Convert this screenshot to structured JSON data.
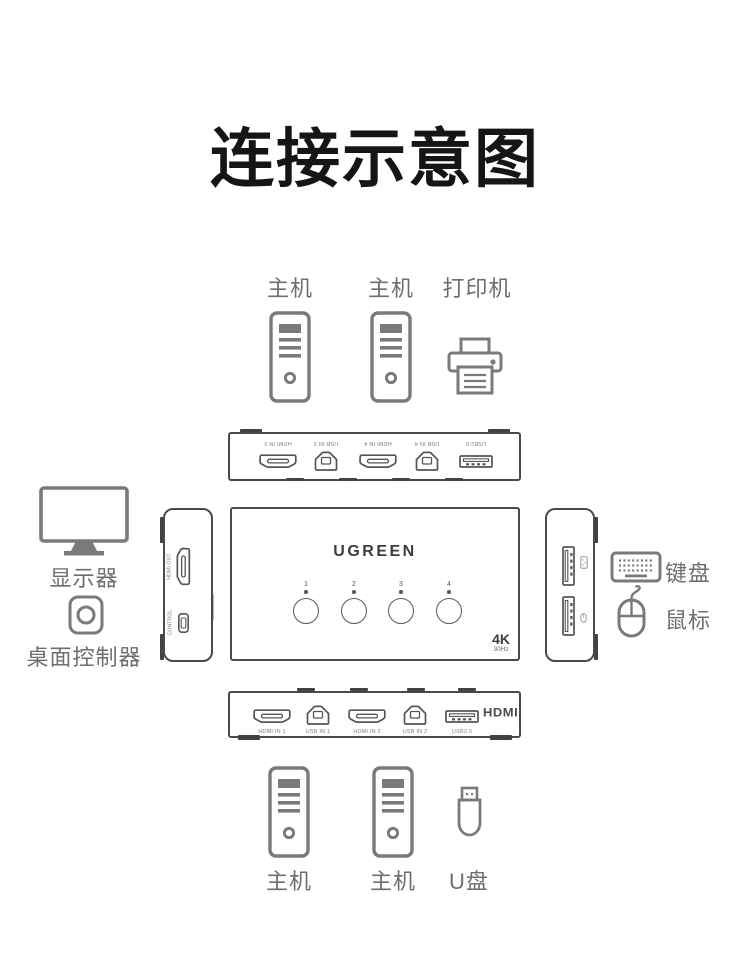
{
  "title": "连接示意图",
  "colors": {
    "title": "#151515",
    "line_art": "#7a7a7a",
    "panel_border": "#4a4a4a",
    "label_gray": "#6e6e6e"
  },
  "top_devices": {
    "computer1_label": "主机",
    "computer2_label": "主机",
    "printer_label": "打印机"
  },
  "rear_panel": {
    "ports": [
      {
        "type": "hdmi",
        "label": "HDMI IN 3"
      },
      {
        "type": "usb-b",
        "label": "USB IN 3"
      },
      {
        "type": "hdmi",
        "label": "HDMI IN 4"
      },
      {
        "type": "usb-b",
        "label": "USB IN 4"
      },
      {
        "type": "usb-a",
        "label": "USB2.0"
      }
    ]
  },
  "device": {
    "brand": "UGREEN",
    "buttons": [
      "1",
      "2",
      "3",
      "4"
    ],
    "badge_resolution": "4K",
    "badge_refresh": "30Hz"
  },
  "left_panel": {
    "hdmi_out_label": "HDMI OUT",
    "control_label": "CONTROL"
  },
  "left_devices": {
    "monitor_label": "显示器",
    "controller_label": "桌面控制器"
  },
  "right_devices": {
    "keyboard_label": "键盘",
    "mouse_label": "鼠标"
  },
  "front_panel": {
    "ports": [
      {
        "type": "hdmi",
        "label": "HDMI IN 1"
      },
      {
        "type": "usb-b",
        "label": "USB IN 1"
      },
      {
        "type": "hdmi",
        "label": "HDMI IN 2"
      },
      {
        "type": "usb-b",
        "label": "USB IN 2"
      },
      {
        "type": "usb-a",
        "label": "USB2.0"
      }
    ],
    "hdmi_logo": "HDMI"
  },
  "bottom_devices": {
    "computer3_label": "主机",
    "computer4_label": "主机",
    "usb_drive_label": "U盘"
  }
}
